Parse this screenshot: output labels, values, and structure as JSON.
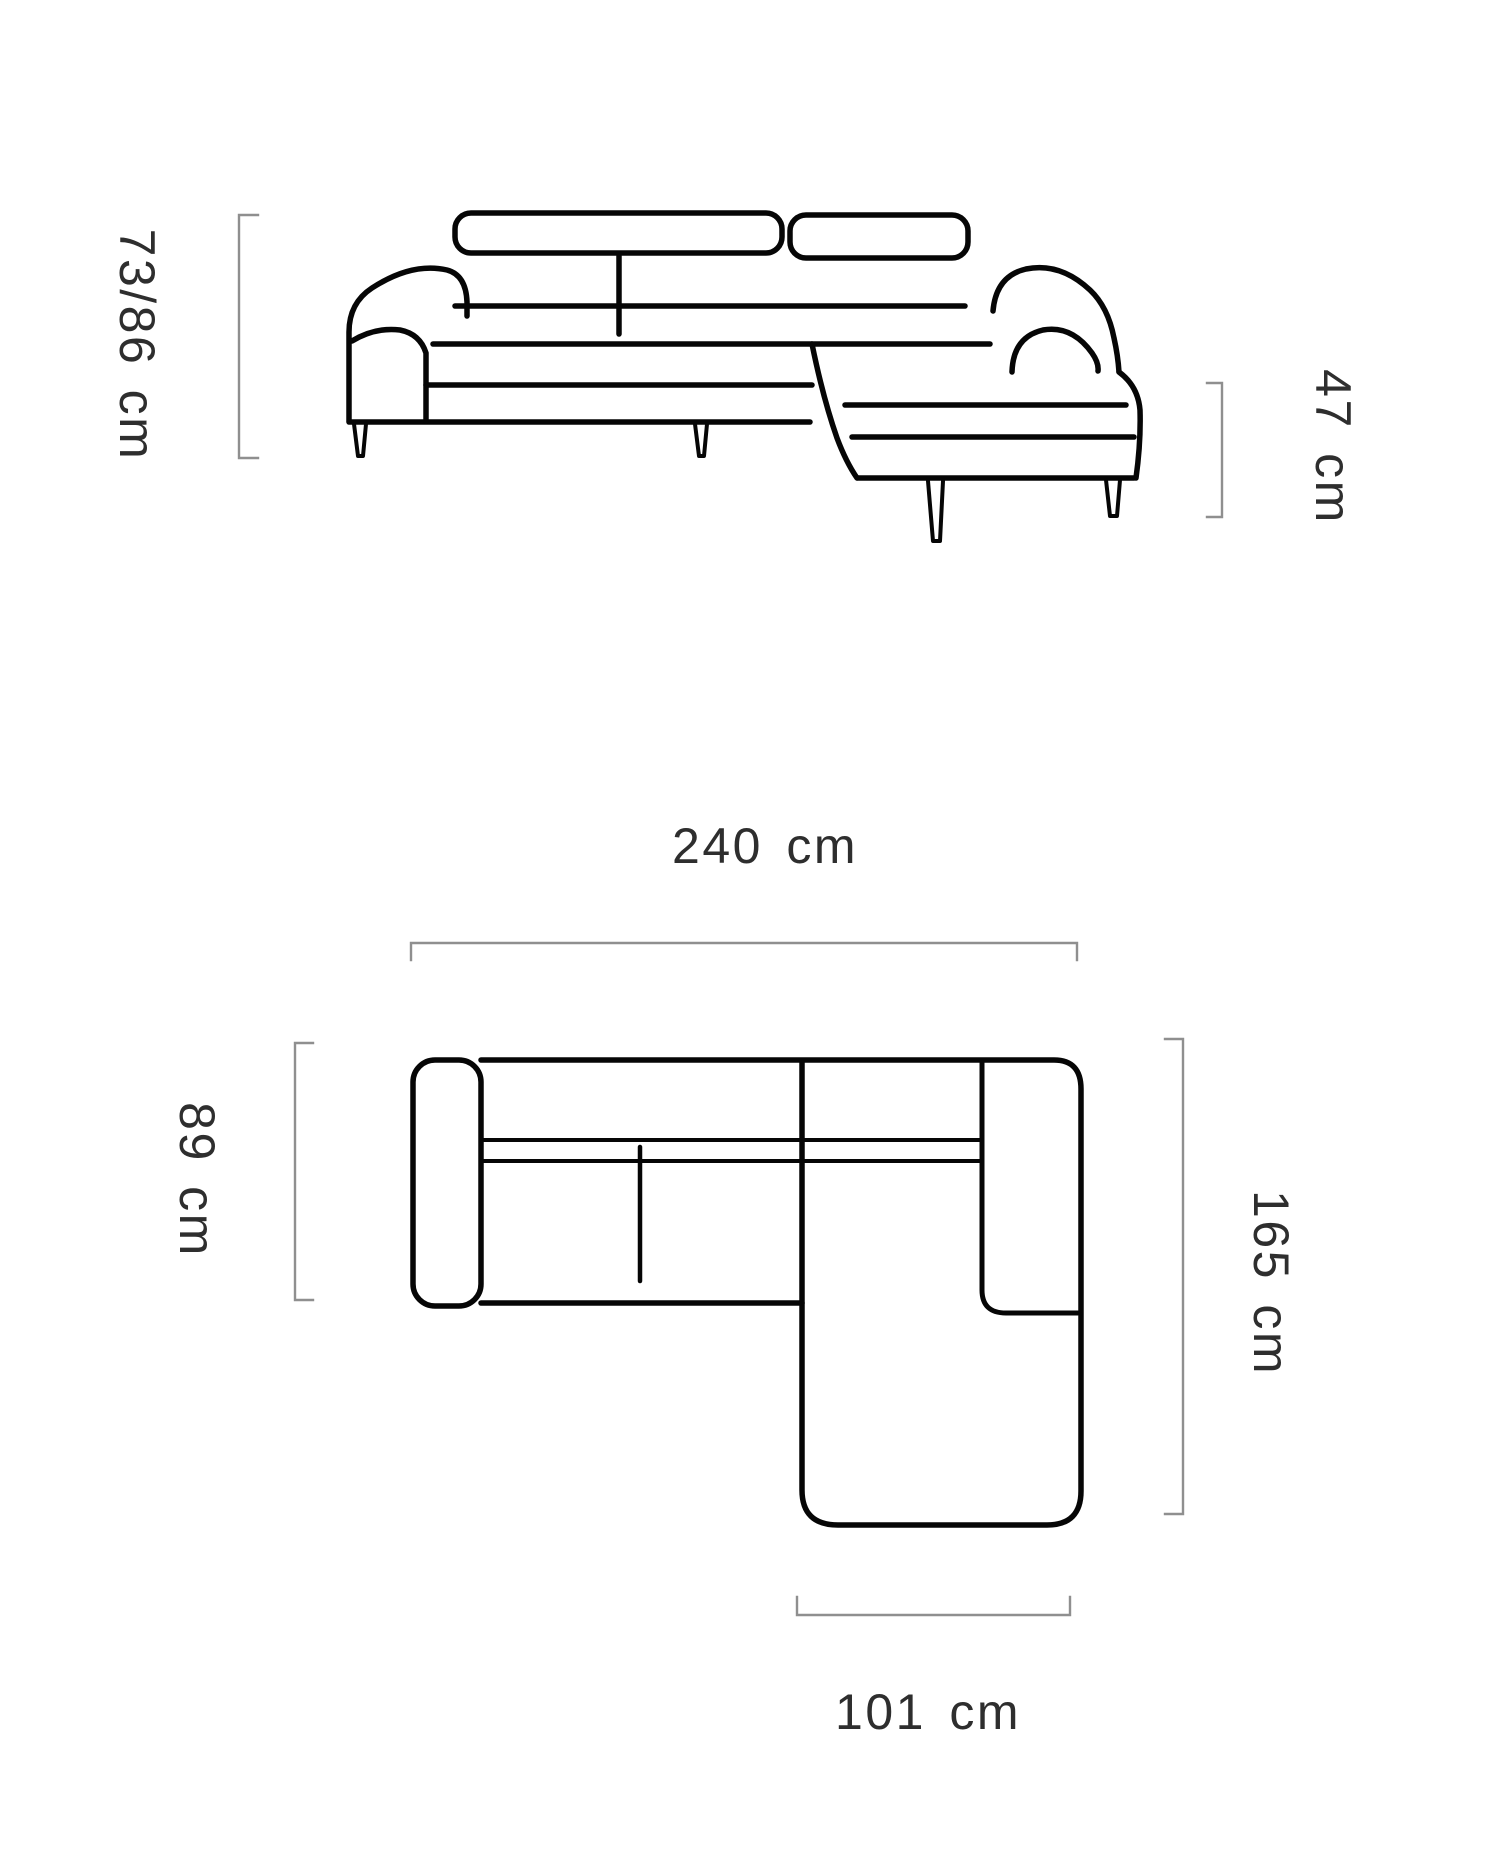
{
  "page": {
    "background": "#ffffff"
  },
  "style": {
    "sofa_line_color": "#060606",
    "dimension_line_color": "#8f8f8f",
    "label_color": "#2e2e2e"
  },
  "side_view": {
    "name": "corner-sofa side elevation drawing",
    "dimensions": {
      "height": {
        "value": "73/86",
        "unit": "cm",
        "label": "73/86 cm",
        "position": "left",
        "orientation": "vertical"
      },
      "seat_height": {
        "value": "47",
        "unit": "cm",
        "label": "47 cm",
        "position": "right",
        "orientation": "vertical"
      }
    }
  },
  "top_view": {
    "name": "corner-sofa top plan drawing",
    "dimensions": {
      "total_width": {
        "value": "240",
        "unit": "cm",
        "label": "240 cm",
        "position": "top",
        "orientation": "horizontal"
      },
      "body_depth": {
        "value": "89",
        "unit": "cm",
        "label": "89 cm",
        "position": "left",
        "orientation": "vertical"
      },
      "total_depth": {
        "value": "165",
        "unit": "cm",
        "label": "165 cm",
        "position": "right",
        "orientation": "vertical"
      },
      "chaise_width": {
        "value": "101",
        "unit": "cm",
        "label": "101 cm",
        "position": "bottom",
        "orientation": "horizontal"
      }
    }
  }
}
